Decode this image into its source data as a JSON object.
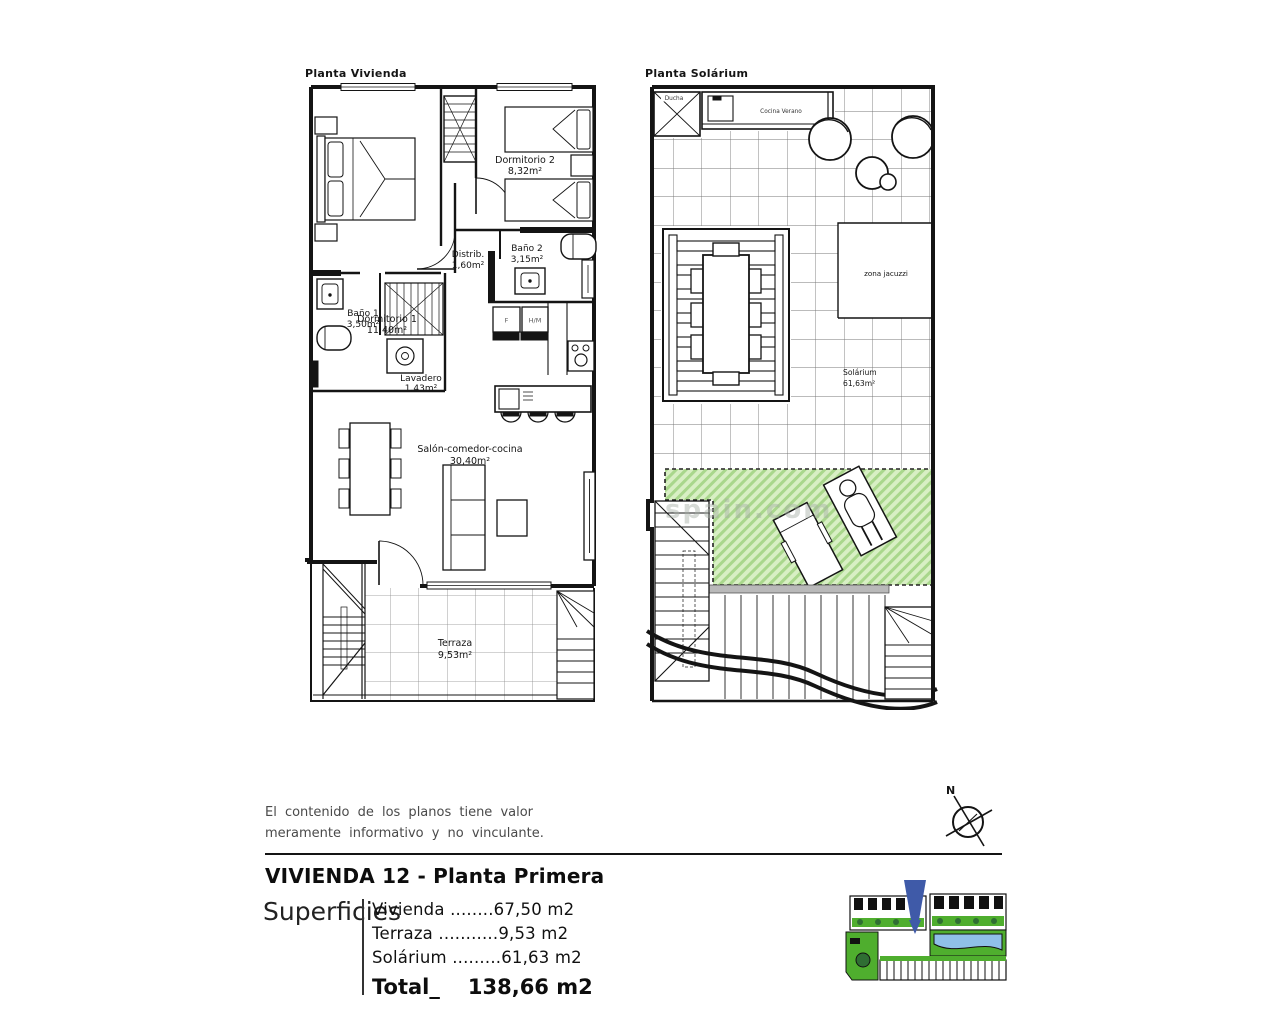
{
  "watermark": "spain.com",
  "plan_vivienda": {
    "title": "Planta Vivienda",
    "rooms": {
      "dormitorio1": {
        "name": "Dormitorio 1",
        "area": "11,40m²"
      },
      "dormitorio2": {
        "name": "Dormitorio 2",
        "area": "8,32m²"
      },
      "distribuidor": {
        "name": "Distrib.",
        "area": "1,60m²"
      },
      "bano2": {
        "name": "Baño 2",
        "area": "3,15m²"
      },
      "bano1": {
        "name": "Baño 1",
        "area": "3,50m²"
      },
      "lavadero": {
        "name": "Lavadero",
        "area": "1,43m²"
      },
      "salon": {
        "name": "Salón-comedor-cocina",
        "area": "30,40m²"
      },
      "terraza": {
        "name": "Terraza",
        "area": "9,53m²"
      }
    },
    "appliances": {
      "fridge": "F",
      "oven_micro": "H/M"
    }
  },
  "plan_solarium": {
    "title": "Planta Solárium",
    "labels": {
      "ducha": "Ducha",
      "cocina_verano": "Cocina Verano",
      "zona_jacuzzi": "zona jacuzzi",
      "solarium_name": "Solárium",
      "solarium_area": "61,63m²"
    }
  },
  "footer": {
    "disclaimer_line1": "El contenido de los planos tiene valor",
    "disclaimer_line2": "meramente informativo y no vinculante.",
    "compass_north": "N",
    "unit_title": "VIVIENDA 12 - Planta Primera",
    "superficies_label": "Superficies",
    "surface_rows": [
      "Vivienda ........67,50 m2",
      "Terraza ...........9,53 m2",
      "Solárium .........61,63 m2"
    ],
    "total_label": "Total_",
    "total_value": "138,66 m2"
  },
  "colors": {
    "deck_green_bg": "#d8efc4",
    "deck_green_stripe": "#a9d78c",
    "site_green": "#4fae2e",
    "site_dark_green": "#2f6e33",
    "pool_blue": "#8fc0e8",
    "marker_blue": "#3f5aa8",
    "line_black": "#141414"
  }
}
